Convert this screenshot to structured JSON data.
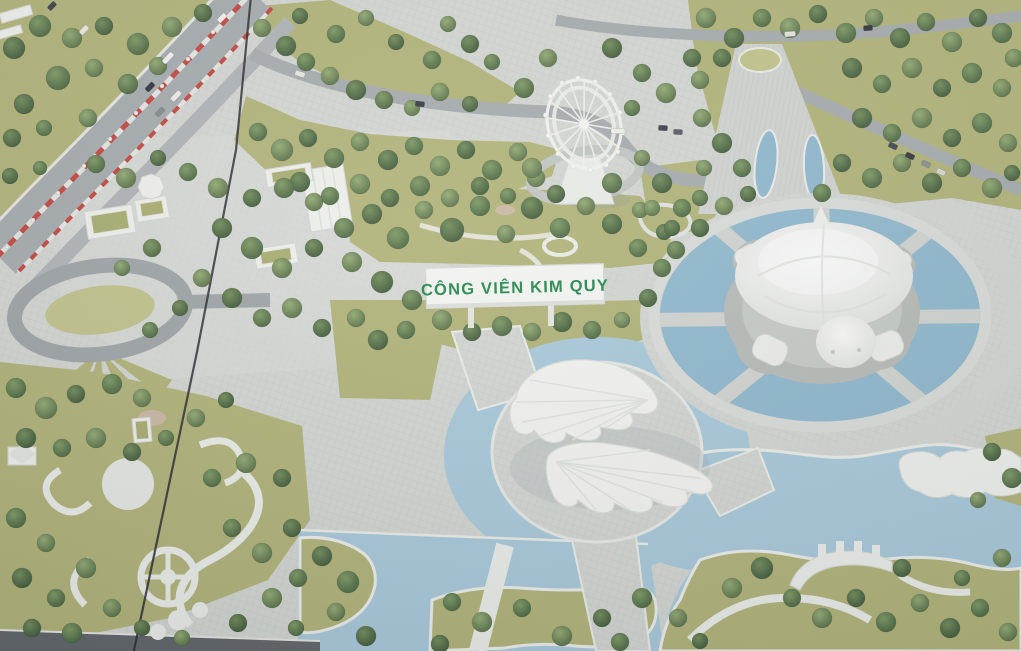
{
  "scene": {
    "description": "Aerial photograph of an architectural scale model of Kim Quy amusement park",
    "sign_text": "CÔNG VIÊN KIM QUY"
  },
  "landmarks": [
    "park-name-sign",
    "turtle-shaped-building",
    "circular-turtle-pond",
    "ferris-wheel",
    "leaf-shaped-buildings",
    "round-plaza-with-moat",
    "lake",
    "highway-with-striped-median",
    "teardrop-roundabout",
    "ornamental-swirl-paths",
    "entrance-avenue-with-eye-ponds",
    "green-roof-buildings",
    "model-panel-seam"
  ],
  "colors": {
    "paving": "#d4d7d2",
    "pavingLight": "#dcded9",
    "grass": "#b2b477",
    "grassLight": "#c2c48a",
    "water": "#a9cadb",
    "pond": "#8fb9ce",
    "road": "#a6abad",
    "roadDark": "#5f6366",
    "pathWhite": "#edefe9",
    "white": "#f2f3ee",
    "roof": "#a9ad6e",
    "signGreen": "#1e8748",
    "stripeRed": "#c2443c",
    "seam": "#26262b",
    "tree": "#4a663f"
  },
  "ferris": {
    "cx": 584,
    "cy": 124,
    "rx": 36,
    "ry": 45,
    "rot": -18,
    "spokes": 16,
    "cabins": 14
  },
  "trees": [
    [
      14,
      48,
      11
    ],
    [
      40,
      26,
      11
    ],
    [
      72,
      38,
      10
    ],
    [
      104,
      26,
      9
    ],
    [
      138,
      44,
      11
    ],
    [
      172,
      27,
      10
    ],
    [
      203,
      13,
      9
    ],
    [
      58,
      78,
      12
    ],
    [
      94,
      68,
      9
    ],
    [
      24,
      104,
      10
    ],
    [
      128,
      84,
      10
    ],
    [
      158,
      66,
      9
    ],
    [
      12,
      138,
      9
    ],
    [
      44,
      128,
      8
    ],
    [
      88,
      118,
      9
    ],
    [
      10,
      176,
      8
    ],
    [
      40,
      168,
      7
    ],
    [
      262,
      28,
      9
    ],
    [
      286,
      46,
      10
    ],
    [
      306,
      62,
      9
    ],
    [
      330,
      76,
      9
    ],
    [
      356,
      90,
      10
    ],
    [
      384,
      100,
      9
    ],
    [
      412,
      108,
      8
    ],
    [
      300,
      16,
      8
    ],
    [
      336,
      34,
      9
    ],
    [
      366,
      18,
      8
    ],
    [
      396,
      42,
      8
    ],
    [
      432,
      60,
      9
    ],
    [
      448,
      24,
      8
    ],
    [
      470,
      44,
      9
    ],
    [
      492,
      62,
      8
    ],
    [
      440,
      92,
      9
    ],
    [
      470,
      104,
      8
    ],
    [
      258,
      132,
      9
    ],
    [
      282,
      150,
      11
    ],
    [
      308,
      138,
      9
    ],
    [
      334,
      158,
      10
    ],
    [
      360,
      142,
      9
    ],
    [
      388,
      160,
      10
    ],
    [
      414,
      146,
      9
    ],
    [
      440,
      166,
      10
    ],
    [
      466,
      150,
      9
    ],
    [
      492,
      170,
      10
    ],
    [
      518,
      152,
      9
    ],
    [
      300,
      182,
      10
    ],
    [
      330,
      196,
      9
    ],
    [
      360,
      184,
      10
    ],
    [
      390,
      198,
      9
    ],
    [
      420,
      186,
      10
    ],
    [
      450,
      198,
      9
    ],
    [
      480,
      186,
      9
    ],
    [
      508,
      196,
      8
    ],
    [
      536,
      178,
      9
    ],
    [
      372,
      214,
      10
    ],
    [
      398,
      238,
      11
    ],
    [
      424,
      210,
      9
    ],
    [
      452,
      230,
      12
    ],
    [
      480,
      206,
      10
    ],
    [
      506,
      234,
      9
    ],
    [
      532,
      208,
      11
    ],
    [
      560,
      228,
      10
    ],
    [
      586,
      206,
      9
    ],
    [
      612,
      224,
      10
    ],
    [
      638,
      248,
      9
    ],
    [
      352,
      262,
      10
    ],
    [
      382,
      282,
      11
    ],
    [
      412,
      300,
      10
    ],
    [
      356,
      318,
      9
    ],
    [
      378,
      340,
      10
    ],
    [
      406,
      330,
      9
    ],
    [
      442,
      320,
      10
    ],
    [
      472,
      332,
      9
    ],
    [
      502,
      326,
      10
    ],
    [
      532,
      332,
      9
    ],
    [
      562,
      322,
      10
    ],
    [
      592,
      330,
      9
    ],
    [
      622,
      320,
      8
    ],
    [
      648,
      298,
      9
    ],
    [
      662,
      268,
      9
    ],
    [
      640,
      210,
      8
    ],
    [
      664,
      232,
      8
    ],
    [
      16,
      388,
      10
    ],
    [
      46,
      408,
      11
    ],
    [
      76,
      394,
      9
    ],
    [
      112,
      384,
      10
    ],
    [
      142,
      398,
      9
    ],
    [
      26,
      438,
      10
    ],
    [
      62,
      448,
      9
    ],
    [
      96,
      438,
      10
    ],
    [
      132,
      452,
      9
    ],
    [
      166,
      438,
      8
    ],
    [
      196,
      418,
      9
    ],
    [
      226,
      400,
      8
    ],
    [
      96,
      164,
      9
    ],
    [
      126,
      178,
      10
    ],
    [
      158,
      158,
      8
    ],
    [
      188,
      172,
      9
    ],
    [
      218,
      188,
      10
    ],
    [
      252,
      198,
      9
    ],
    [
      284,
      188,
      10
    ],
    [
      314,
      202,
      9
    ],
    [
      222,
      228,
      10
    ],
    [
      252,
      248,
      11
    ],
    [
      282,
      268,
      10
    ],
    [
      314,
      248,
      9
    ],
    [
      344,
      228,
      10
    ],
    [
      202,
      278,
      9
    ],
    [
      232,
      298,
      10
    ],
    [
      262,
      318,
      9
    ],
    [
      292,
      308,
      10
    ],
    [
      322,
      328,
      9
    ],
    [
      152,
      248,
      9
    ],
    [
      122,
      268,
      8
    ],
    [
      180,
      308,
      8
    ],
    [
      150,
      330,
      8
    ],
    [
      706,
      18,
      10
    ],
    [
      734,
      38,
      10
    ],
    [
      762,
      18,
      9
    ],
    [
      790,
      28,
      10
    ],
    [
      818,
      14,
      9
    ],
    [
      846,
      33,
      10
    ],
    [
      874,
      18,
      9
    ],
    [
      900,
      38,
      10
    ],
    [
      926,
      22,
      9
    ],
    [
      952,
      42,
      10
    ],
    [
      978,
      18,
      9
    ],
    [
      1002,
      33,
      10
    ],
    [
      1014,
      58,
      9
    ],
    [
      852,
      68,
      10
    ],
    [
      882,
      84,
      9
    ],
    [
      912,
      68,
      10
    ],
    [
      942,
      88,
      9
    ],
    [
      972,
      73,
      10
    ],
    [
      1002,
      88,
      9
    ],
    [
      862,
      118,
      10
    ],
    [
      892,
      133,
      9
    ],
    [
      922,
      118,
      10
    ],
    [
      952,
      138,
      9
    ],
    [
      982,
      123,
      10
    ],
    [
      1008,
      143,
      9
    ],
    [
      842,
      163,
      9
    ],
    [
      872,
      178,
      10
    ],
    [
      902,
      163,
      9
    ],
    [
      932,
      183,
      10
    ],
    [
      962,
      168,
      9
    ],
    [
      992,
      188,
      10
    ],
    [
      1012,
      173,
      8
    ],
    [
      822,
      193,
      9
    ],
    [
      702,
      118,
      9
    ],
    [
      722,
      143,
      10
    ],
    [
      742,
      168,
      9
    ],
    [
      700,
      80,
      9
    ],
    [
      722,
      58,
      9
    ],
    [
      524,
      88,
      10
    ],
    [
      548,
      58,
      9
    ],
    [
      612,
      48,
      10
    ],
    [
      642,
      73,
      9
    ],
    [
      666,
      93,
      10
    ],
    [
      692,
      58,
      9
    ],
    [
      632,
      108,
      8
    ],
    [
      532,
      168,
      10
    ],
    [
      556,
      194,
      9
    ],
    [
      612,
      183,
      10
    ],
    [
      642,
      158,
      8
    ],
    [
      662,
      183,
      10
    ],
    [
      682,
      208,
      9
    ],
    [
      704,
      168,
      8
    ],
    [
      700,
      228,
      9
    ],
    [
      676,
      250,
      9
    ],
    [
      652,
      208,
      8
    ],
    [
      672,
      228,
      8
    ],
    [
      700,
      198,
      8
    ],
    [
      724,
      206,
      9
    ],
    [
      748,
      194,
      8
    ],
    [
      16,
      518,
      10
    ],
    [
      46,
      543,
      9
    ],
    [
      22,
      578,
      10
    ],
    [
      56,
      598,
      9
    ],
    [
      86,
      568,
      10
    ],
    [
      32,
      628,
      9
    ],
    [
      72,
      633,
      10
    ],
    [
      112,
      608,
      9
    ],
    [
      142,
      628,
      8
    ],
    [
      212,
      478,
      9
    ],
    [
      246,
      463,
      10
    ],
    [
      282,
      478,
      9
    ],
    [
      232,
      528,
      9
    ],
    [
      262,
      553,
      10
    ],
    [
      292,
      528,
      9
    ],
    [
      298,
      578,
      9
    ],
    [
      272,
      598,
      10
    ],
    [
      238,
      623,
      9
    ],
    [
      296,
      628,
      8
    ],
    [
      182,
      638,
      8
    ],
    [
      322,
      556,
      10
    ],
    [
      348,
      582,
      11
    ],
    [
      336,
      612,
      9
    ],
    [
      366,
      636,
      10
    ],
    [
      452,
      602,
      9
    ],
    [
      482,
      622,
      10
    ],
    [
      440,
      644,
      9
    ],
    [
      522,
      608,
      9
    ],
    [
      562,
      636,
      10
    ],
    [
      602,
      618,
      9
    ],
    [
      642,
      598,
      10
    ],
    [
      678,
      618,
      9
    ],
    [
      700,
      641,
      8
    ],
    [
      620,
      642,
      9
    ],
    [
      732,
      588,
      10
    ],
    [
      762,
      568,
      11
    ],
    [
      792,
      598,
      9
    ],
    [
      822,
      618,
      10
    ],
    [
      856,
      598,
      9
    ],
    [
      886,
      622,
      10
    ],
    [
      920,
      603,
      9
    ],
    [
      950,
      628,
      10
    ],
    [
      980,
      608,
      9
    ],
    [
      1008,
      632,
      9
    ],
    [
      902,
      568,
      9
    ],
    [
      962,
      578,
      8
    ],
    [
      1002,
      558,
      9
    ],
    [
      992,
      452,
      9
    ],
    [
      1012,
      478,
      10
    ],
    [
      978,
      500,
      8
    ]
  ],
  "cars": [
    [
      168,
      58,
      -46,
      "#f4f4f0",
      13
    ],
    [
      150,
      87,
      -46,
      "#2e2e36",
      10
    ],
    [
      176,
      96,
      -46,
      "#f0f0ea",
      12
    ],
    [
      160,
      112,
      -46,
      "#85898e",
      10
    ],
    [
      84,
      30,
      -46,
      "#ecece6",
      10
    ],
    [
      52,
      6,
      -46,
      "#3c3c44",
      9
    ],
    [
      222,
      18,
      -46,
      "#f2f2ec",
      10
    ],
    [
      300,
      74,
      18,
      "#e9e9e3",
      10
    ],
    [
      420,
      104,
      6,
      "#34343e",
      9
    ],
    [
      790,
      34,
      -4,
      "#e8e8e2",
      11
    ],
    [
      868,
      28,
      -4,
      "#303038",
      9
    ],
    [
      893,
      146,
      25,
      "#44444c",
      9
    ],
    [
      910,
      156,
      25,
      "#34343c",
      9
    ],
    [
      926,
      164,
      25,
      "#8b8f94",
      9
    ],
    [
      941,
      172,
      25,
      "#d8d8d2",
      9
    ],
    [
      663,
      128,
      2,
      "#3a3a42",
      9
    ],
    [
      678,
      132,
      2,
      "#565660",
      9
    ],
    [
      618,
      131,
      0,
      "#f2f2ec",
      14
    ]
  ],
  "lamps": [
    [
      213,
      32
    ],
    [
      188,
      59
    ],
    [
      162,
      86
    ],
    [
      136,
      113
    ],
    [
      110,
      139
    ],
    [
      84,
      166
    ],
    [
      58,
      193
    ],
    [
      33,
      220
    ],
    [
      7,
      247
    ]
  ]
}
